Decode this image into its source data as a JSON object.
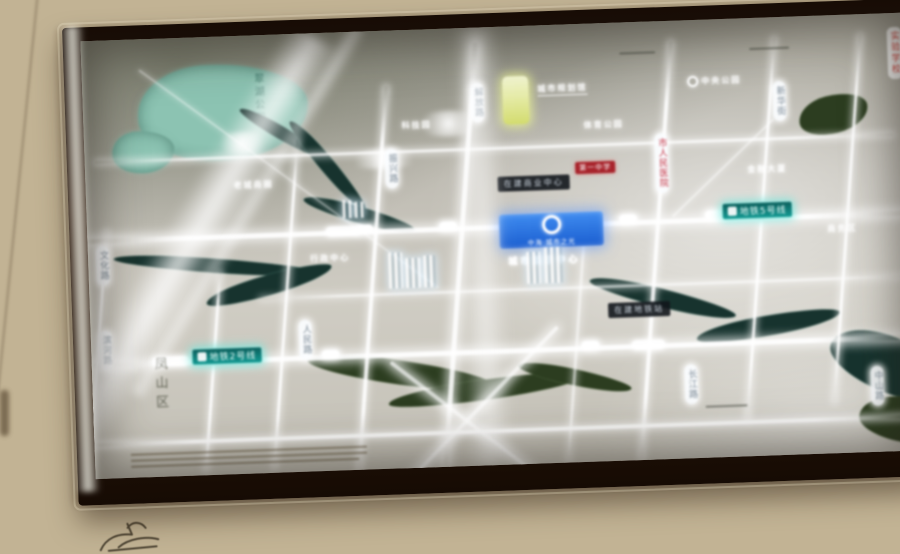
{
  "map": {
    "lake_label": "翠湖公园",
    "district_label": "凤山区",
    "metro_badges": [
      {
        "label": "地铁5号线"
      },
      {
        "label": "地铁2号线"
      }
    ],
    "dark_strips": [
      {
        "label": "在建商业中心"
      },
      {
        "label": "在建地铁站"
      }
    ],
    "project_badge": {
      "name": "中海·城市之光"
    },
    "project_glow_label": "城市展示中心",
    "road_pills": [
      {
        "label": "文化路"
      },
      {
        "label": "滨河路"
      },
      {
        "label": "人民路"
      },
      {
        "label": "解放路"
      },
      {
        "label": "长江路"
      },
      {
        "label": "新华街"
      },
      {
        "label": "振兴路"
      },
      {
        "label": "中山路"
      }
    ],
    "poi_labels": [
      {
        "label": "科技园"
      },
      {
        "label": "城市规划馆"
      },
      {
        "label": "中央公园"
      },
      {
        "label": "金融大厦"
      },
      {
        "label": "行政中心"
      },
      {
        "label": "体育公园"
      },
      {
        "label": "老城商圈"
      },
      {
        "label": "商务区"
      }
    ],
    "red_labels": [
      {
        "label": "市人民医院"
      },
      {
        "label": "第一中学"
      },
      {
        "label": "实验学校"
      }
    ]
  },
  "colors": {
    "wall": "#cfc1a3",
    "frame": "#241509",
    "map_base": "#c2bfb6",
    "road_glow": "#ffffff",
    "water": "#17332e",
    "park": "#2c3d20",
    "lake": "#8cc3b2",
    "metro_badge": "#139a93",
    "project_blue": "#1b5ed0",
    "landmark_yellow": "#d3dc6e",
    "red_text": "#cc3333"
  }
}
